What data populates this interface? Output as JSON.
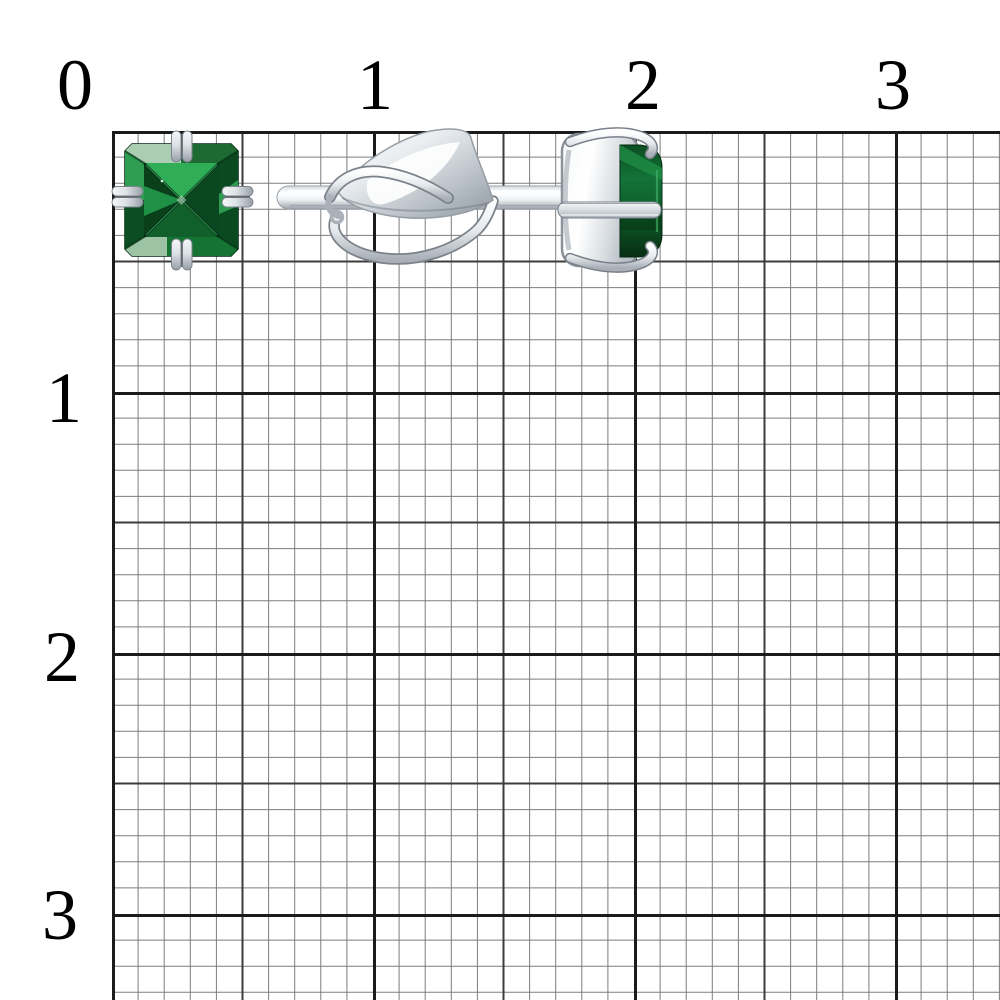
{
  "ruler": {
    "top_ticks": [
      {
        "label": "0"
      },
      {
        "label": "1"
      },
      {
        "label": "2"
      },
      {
        "label": "3"
      }
    ],
    "left_ticks": [
      {
        "label": "1"
      },
      {
        "label": "2"
      },
      {
        "label": "3"
      }
    ]
  },
  "palette": {
    "background": "#ffffff",
    "tick_label_color": "#000000",
    "grid_minor_line": "#7d7d7d",
    "grid_medium_line": "#3c3c3c",
    "grid_major_line": "#1b1b1b",
    "gem_green_bright": "#2fae57",
    "gem_green_mid": "#15813c",
    "gem_green_dark": "#0a3f1c",
    "metal_highlight": "#ffffff",
    "metal_mid": "#c9cfd5",
    "metal_shadow": "#8b929a"
  }
}
